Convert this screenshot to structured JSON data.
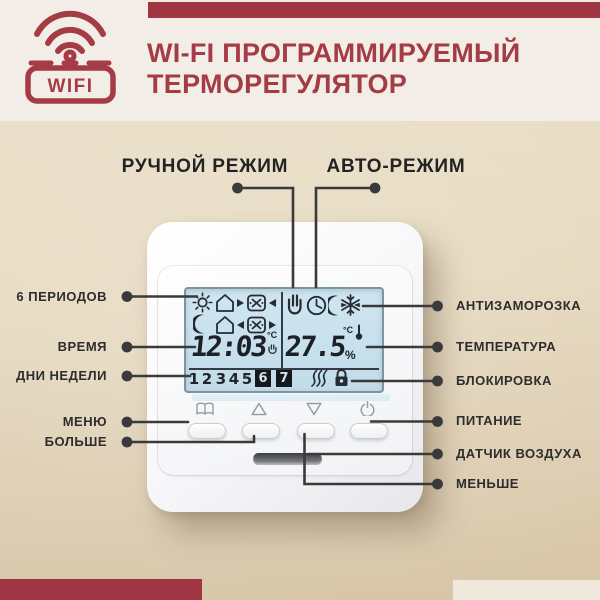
{
  "colors": {
    "accent_red": "#9F3641",
    "title_red": "#A43B45",
    "background_cream": "#F2EEE7",
    "background_tan": "#E0D1B4",
    "lcd_blue": "#C9E2EF",
    "connector_dark": "#3A3A3A"
  },
  "header": {
    "wifi_badge": "WIFI",
    "title_line1": "WI-FI ПРОГРАММИРУЕМЫЙ",
    "title_line2": "ТЕРМОРЕГУЛЯТОР"
  },
  "mode_labels": {
    "manual": "РУЧНОЙ РЕЖИМ",
    "auto": "АВТО-РЕЖИМ"
  },
  "callouts_left": [
    "6 ПЕРИОДОВ",
    "ВРЕМЯ",
    "ДНИ НЕДЕЛИ",
    "МЕНЮ",
    "БОЛЬШЕ"
  ],
  "callouts_right": [
    "АНТИЗАМОРОЗКА",
    "ТЕМПЕРАТУРА",
    "БЛОКИРОВКА",
    "ПИТАНИЕ",
    "ДАТЧИК ВОЗДУХА",
    "МЕНЬШЕ"
  ],
  "display": {
    "time": "12:03",
    "time_unit": "°C",
    "temperature": "27.5",
    "temperature_unit": "°C",
    "humidity_unit": "%",
    "days": [
      "1",
      "2",
      "3",
      "4",
      "5",
      "6",
      "7"
    ]
  },
  "icons": {
    "logo": "wifi-icon",
    "period_row1": [
      "sun-icon",
      "house-leave-icon",
      "work-arrive-icon"
    ],
    "period_row2": [
      "moon-icon",
      "house-return-icon",
      "work-leave-icon"
    ],
    "mode_row": [
      "hand-manual-icon",
      "clock-auto-icon",
      "night-moon-icon",
      "snowflake-frost-icon"
    ],
    "status_row": [
      "heating-waves-icon",
      "lock-icon"
    ],
    "temperature": "thermometer-icon",
    "buttons": [
      "menu-book-icon",
      "arrow-up-icon",
      "arrow-down-icon",
      "power-icon"
    ]
  }
}
